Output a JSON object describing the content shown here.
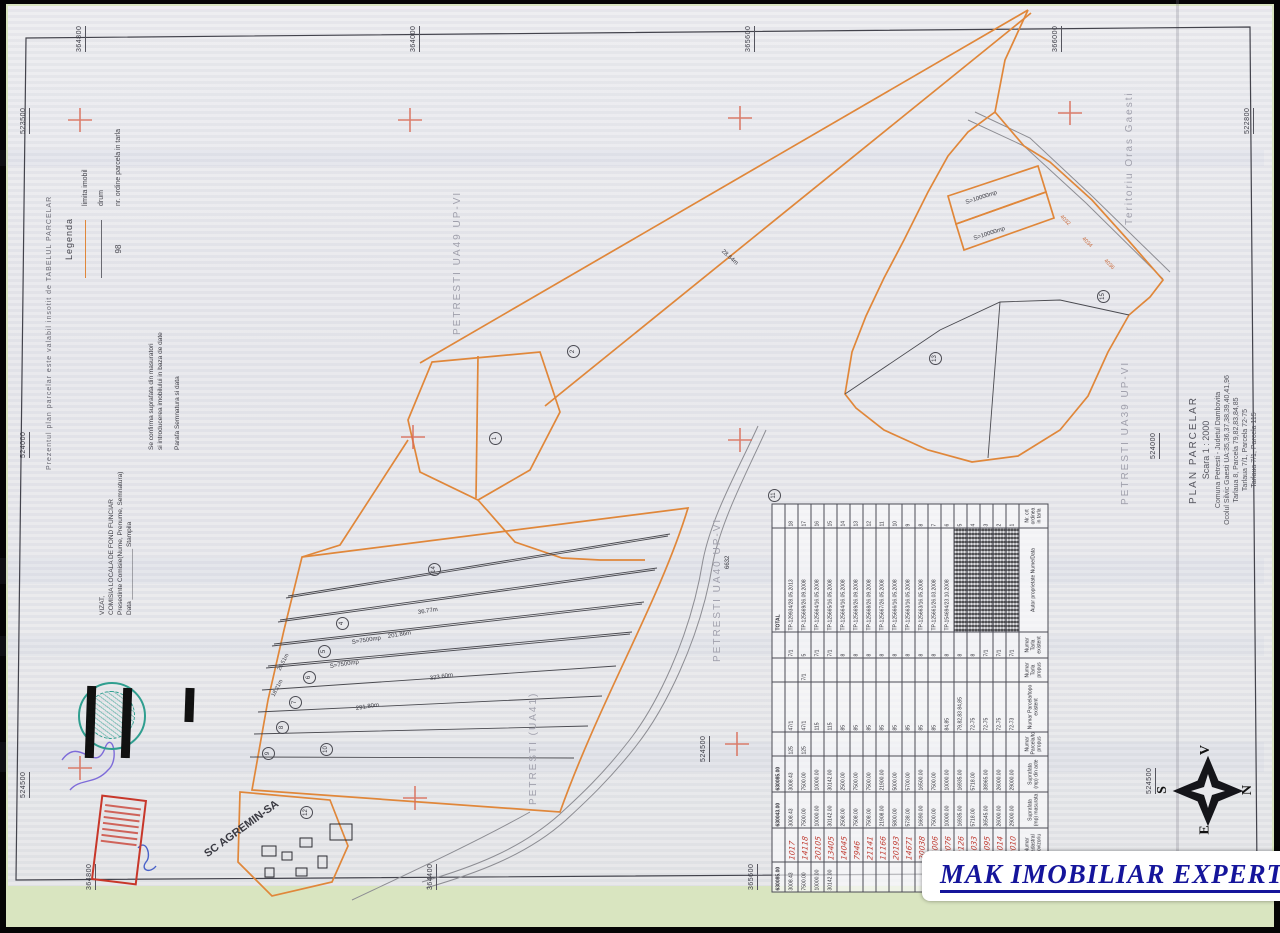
{
  "title_block": {
    "lines": [
      "PLAN PARCELAR",
      "Scara 1 : 2000",
      "Comuna Petresti - Judetul Dambovita",
      "Ocolul Silvic Gaesti UA:35,36,37,38,39,40,41,96",
      "Tarlaua 8, Parcela 79,82,83,84,85",
      "Tarlaua 7/1, Parcela 72-75",
      "Tarlaua 7/1, Parcela 115"
    ]
  },
  "margin_note": "Prezentul plan parcelar este valabil insotit de TABELUL PARCELAR",
  "legend": {
    "title": "Legenda",
    "items": [
      {
        "kind": "orange",
        "label": "limita imobil"
      },
      {
        "kind": "plain",
        "label": "drum"
      },
      {
        "kind": "number",
        "symbol": "98",
        "label": "nr. ordine parcela in tarla"
      }
    ]
  },
  "certifications": {
    "confirm": {
      "lines": [
        "Se confirma suprafata din masuratori",
        "si introducerea imobilului in baza de date",
        "",
        "Parafa            Semnatura si data"
      ]
    },
    "vizat": {
      "lines": [
        "VIZAT,",
        "COMISIA LOCALA DE FOND FUNCIAR",
        "Presedinte Comisie(Nume, Prenume, Semnatura)",
        "Data ______________          Stampila"
      ]
    }
  },
  "edge_labels": {
    "top": [
      {
        "t": "364800",
        "x": 76
      },
      {
        "t": "364000",
        "x": 410
      },
      {
        "t": "365600",
        "x": 745
      },
      {
        "t": "366000",
        "x": 1052
      }
    ],
    "bottom": [
      {
        "t": "364800",
        "x": 86
      },
      {
        "t": "364400",
        "x": 427
      },
      {
        "t": "365600",
        "x": 748
      }
    ],
    "left": [
      {
        "t": "523500",
        "y": 112
      },
      {
        "t": "524000",
        "y": 436
      },
      {
        "t": "524500",
        "y": 776
      }
    ],
    "right": [
      {
        "t": "522800",
        "y": 112,
        "x": 1244
      },
      {
        "t": "524000",
        "y": 437,
        "x": 1150
      },
      {
        "t": "524500",
        "y": 772,
        "x": 1146
      }
    ],
    "interior": [
      {
        "t": "524500",
        "x": 700,
        "y": 742
      }
    ]
  },
  "region_labels": [
    {
      "t": "Teritoriu Oras Gaesti",
      "x": 1124,
      "y": 225
    },
    {
      "t": "PETRESTI UA39 UP-VI",
      "x": 1120,
      "y": 505
    },
    {
      "t": "PETRESTI UA49 UP-VI",
      "x": 452,
      "y": 335
    },
    {
      "t": "PETRESTI UA40 UP-VI",
      "x": 712,
      "y": 662
    },
    {
      "t": "PETRESTI (UA41)",
      "x": 528,
      "y": 805
    }
  ],
  "map_labels": [
    {
      "t": "SC AGREMIN-SA",
      "x": 206,
      "y": 850,
      "r": -36,
      "s": 11,
      "b": 1
    },
    {
      "t": "S=10000mp",
      "x": 966,
      "y": 200,
      "r": -18,
      "s": 6
    },
    {
      "t": "S=10000mp",
      "x": 974,
      "y": 236,
      "r": -18,
      "s": 6
    },
    {
      "t": "S=7500mp",
      "x": 352,
      "y": 640,
      "r": -9,
      "s": 6
    },
    {
      "t": "S=7500mp",
      "x": 330,
      "y": 664,
      "r": -9,
      "s": 6
    },
    {
      "t": "323.60m",
      "x": 430,
      "y": 676,
      "r": -9,
      "s": 6
    },
    {
      "t": "291.80m",
      "x": 356,
      "y": 706,
      "r": -9,
      "s": 6
    },
    {
      "t": "201.86m",
      "x": 388,
      "y": 634,
      "r": -9,
      "s": 6
    },
    {
      "t": "36.77m",
      "x": 418,
      "y": 610,
      "r": -9,
      "s": 6
    },
    {
      "t": "26.51m",
      "x": 280,
      "y": 668,
      "r": -62,
      "s": 5.5
    },
    {
      "t": "18.21m",
      "x": 274,
      "y": 694,
      "r": -62,
      "s": 5.5
    },
    {
      "t": "28.64m",
      "x": 722,
      "y": 248,
      "r": 42,
      "s": 6
    },
    {
      "t": "6632",
      "x": 728,
      "y": 566,
      "r": -90,
      "s": 6
    },
    {
      "t": "4036",
      "x": 1104,
      "y": 258,
      "r": 45,
      "s": 5.5,
      "c": "#c96a3a"
    },
    {
      "t": "4034",
      "x": 1082,
      "y": 236,
      "r": 45,
      "s": 5.5,
      "c": "#c96a3a"
    },
    {
      "t": "4032",
      "x": 1060,
      "y": 214,
      "r": 45,
      "s": 5.5,
      "c": "#c96a3a"
    }
  ],
  "circled_numbers": [
    {
      "n": "1",
      "x": 489,
      "y": 432
    },
    {
      "n": "2",
      "x": 567,
      "y": 345
    },
    {
      "n": "11",
      "x": 768,
      "y": 489
    },
    {
      "n": "13",
      "x": 929,
      "y": 352
    },
    {
      "n": "15",
      "x": 1097,
      "y": 290
    },
    {
      "n": "14",
      "x": 428,
      "y": 563
    },
    {
      "n": "4",
      "x": 336,
      "y": 617
    },
    {
      "n": "5",
      "x": 318,
      "y": 645
    },
    {
      "n": "6",
      "x": 303,
      "y": 671
    },
    {
      "n": "7",
      "x": 289,
      "y": 696
    },
    {
      "n": "8",
      "x": 276,
      "y": 721
    },
    {
      "n": "9",
      "x": 262,
      "y": 747
    },
    {
      "n": "10",
      "x": 320,
      "y": 743
    },
    {
      "n": "12",
      "x": 300,
      "y": 806
    }
  ],
  "compass": {
    "top": "V",
    "right": "N",
    "bottom": "E",
    "left": "S"
  },
  "logo": {
    "text": "MAK IMOBILIAR EXPERT"
  },
  "table": {
    "headers": [
      "Nr. crt ordinea in tarla",
      "Autor proprietate Nume/Data",
      "Numar Tarla existent",
      "Numar Tarla propus",
      "Numar Parcela/topo existent",
      "Numar Parcela/topo propus",
      "Suprafata (mp) din acte",
      "Suprafata (mp) masurata",
      "Numar Cadastral Provizoriu",
      "Suprafata (mp)"
    ],
    "rows": [
      {
        "c": [
          "1",
          "",
          "7/1",
          "",
          "72-73",
          "",
          "29000.00",
          "29000.00",
          "20010",
          ""
        ],
        "redacted": true
      },
      {
        "c": [
          "2",
          "",
          "7/1",
          "",
          "72-75",
          "",
          "26000.00",
          "26000.00",
          "24014",
          ""
        ],
        "redacted": true
      },
      {
        "c": [
          "3",
          "",
          "7/1",
          "",
          "72-75",
          "",
          "38965.00",
          "36545.00",
          "21095",
          ""
        ],
        "redacted": true
      },
      {
        "c": [
          "4",
          "",
          "8",
          "",
          "72-75",
          "",
          "5718.00",
          "5718.00",
          "21033",
          ""
        ],
        "redacted": true
      },
      {
        "c": [
          "5",
          "",
          "8",
          "",
          "79,82,83 84,85",
          "",
          "16935.00",
          "16935.00",
          "20126",
          ""
        ],
        "redacted": true
      },
      {
        "c": [
          "6",
          "TP-154694/23.10.2008",
          "8",
          "",
          "84,85",
          "",
          "10000.00",
          "10000.00",
          "20076",
          ""
        ]
      },
      {
        "c": [
          "7",
          "TP-125661/26.03.2008",
          "8",
          "",
          "85",
          "",
          "7500.00",
          "7500.00",
          "24006",
          ""
        ]
      },
      {
        "c": [
          "8",
          "TP-125663/16.05.2008",
          "8",
          "",
          "85",
          "",
          "16500.00",
          "16690.00",
          "20038",
          ""
        ]
      },
      {
        "c": [
          "9",
          "TP-125663/16.05.2008",
          "8",
          "",
          "85",
          "",
          "5700.00",
          "5738.00",
          "14671",
          ""
        ]
      },
      {
        "c": [
          "10",
          "TP-125666/16.05.2008",
          "8",
          "",
          "85",
          "",
          "5000.00",
          "5800.00",
          "20193",
          ""
        ]
      },
      {
        "c": [
          "11",
          "TP-125667/26.05.2008",
          "8",
          "",
          "85",
          "",
          "21900.00",
          "21908.00",
          "11166",
          ""
        ]
      },
      {
        "c": [
          "12",
          "TP-125668/26.09.2008",
          "8",
          "",
          "85",
          "",
          "7500.00",
          "7508.00",
          "21141",
          ""
        ]
      },
      {
        "c": [
          "13",
          "TP-125669/26.09.2008",
          "8",
          "",
          "85",
          "",
          "7500.00",
          "7508.00",
          "7946",
          ""
        ]
      },
      {
        "c": [
          "14",
          "TP-125664/16.05.2008",
          "8",
          "",
          "85",
          "",
          "2500.00",
          "2508.00",
          "14045",
          ""
        ]
      },
      {
        "c": [
          "15",
          "TP-125665/16.05.2008",
          "7/1",
          "",
          "115",
          "",
          "30142.00",
          "30142.00",
          "13405",
          "30142.00"
        ]
      },
      {
        "c": [
          "16",
          "TP-125664/16.05.2008",
          "7/1",
          "",
          "115",
          "",
          "10000.00",
          "10000.00",
          "20105",
          "10000.00"
        ]
      },
      {
        "c": [
          "17",
          "TP-125669/26.09.2008",
          "5",
          "7/1",
          "47/1",
          "125",
          "7500.00",
          "7500.00",
          "14118",
          "7500.00"
        ]
      },
      {
        "c": [
          "18",
          "TP-129934/28.05.2013",
          "7/1",
          "",
          "47/1",
          "125",
          "3008.43",
          "3008.43",
          "1017",
          "3008.43"
        ]
      }
    ],
    "total": {
      "c": [
        "",
        "TOTAL",
        "",
        "",
        "",
        "",
        "630085.00",
        "630043.00",
        "",
        "630085.00"
      ]
    }
  }
}
